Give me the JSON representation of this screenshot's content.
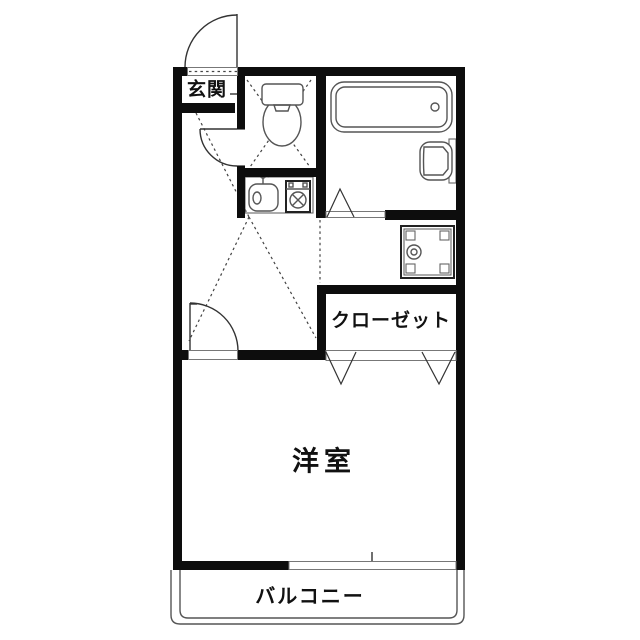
{
  "floorplan": {
    "rooms": {
      "genkan": {
        "label": "玄関"
      },
      "closet": {
        "label": "クローゼット"
      },
      "western_room": {
        "label": "洋室"
      },
      "balcony": {
        "label": "バルコニー"
      }
    },
    "fixtures": [
      "entrance-swing-door",
      "toilet",
      "toilet-swing-door",
      "bathtub",
      "wash-basin",
      "bathroom-folding-door",
      "kitchen-sink",
      "gas-stove",
      "washing-machine-pan",
      "room-swing-door",
      "closet-folding-doors",
      "balcony-window"
    ],
    "colors": {
      "wall": "#0d0d0d",
      "fixture_line": "#555555",
      "dashed_line": "#444444",
      "background": "#ffffff"
    }
  }
}
